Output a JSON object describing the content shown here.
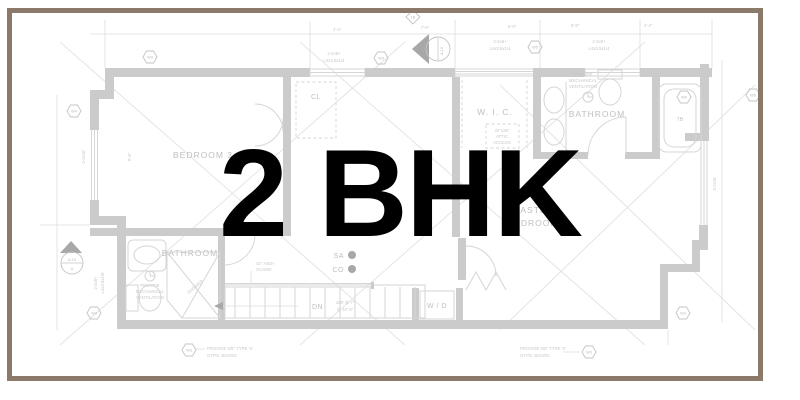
{
  "overlay": {
    "title": "2 BHK"
  },
  "frame": {
    "color": "#8b7a6a"
  },
  "plan": {
    "line_color": "#cbcbcb",
    "labels": {
      "bedroom3": "BEDROOM 3",
      "closet": "CL",
      "wic": "W. I. C.",
      "bathroom_top": "BATHROOM",
      "bathroom_bottom": "BATHROOM",
      "master_1": "MASTER",
      "master_2": "BEDROOM",
      "wd": "W / D",
      "dn": "DN",
      "sa": "SA",
      "co": "CO",
      "tb": "TB",
      "shower": "SHOWER"
    },
    "notes": {
      "attic_1": "22\"x28\"",
      "attic_2": "ATTIC",
      "attic_3": "ACCESS",
      "vent_1": "PROVIDE",
      "vent_2": "MECHANICAL",
      "vent_3": "VENTILATION",
      "gyps_1": "PROVIDE 5/8\" TYPE 'X'",
      "gyps_2": "GYPS. BOARD",
      "guard_1": "42\" HIGH",
      "guard_2": "GUARD",
      "stair_1": "16R @ 7\"",
      "stair_2": "@ 10'-0\""
    },
    "beams": {
      "beam_a": "2-2x8+",
      "beam_b": "L4x3.5x1/4",
      "beam_c": "L4x3.5x1/8",
      "beam_small": "2-2x10"
    },
    "dims": {
      "d1": "4'-4\"",
      "d2": "7'-6\"",
      "d3": "5'-8\"",
      "d4": "8'-8\"",
      "d5": "4'-4\"",
      "d6": "9'-6\""
    },
    "markers": {
      "w3": "W3",
      "w4": "W4",
      "w5": "W5",
      "w6": "W6",
      "a10": "A-10",
      "a": "A",
      "b1": "1B"
    }
  }
}
